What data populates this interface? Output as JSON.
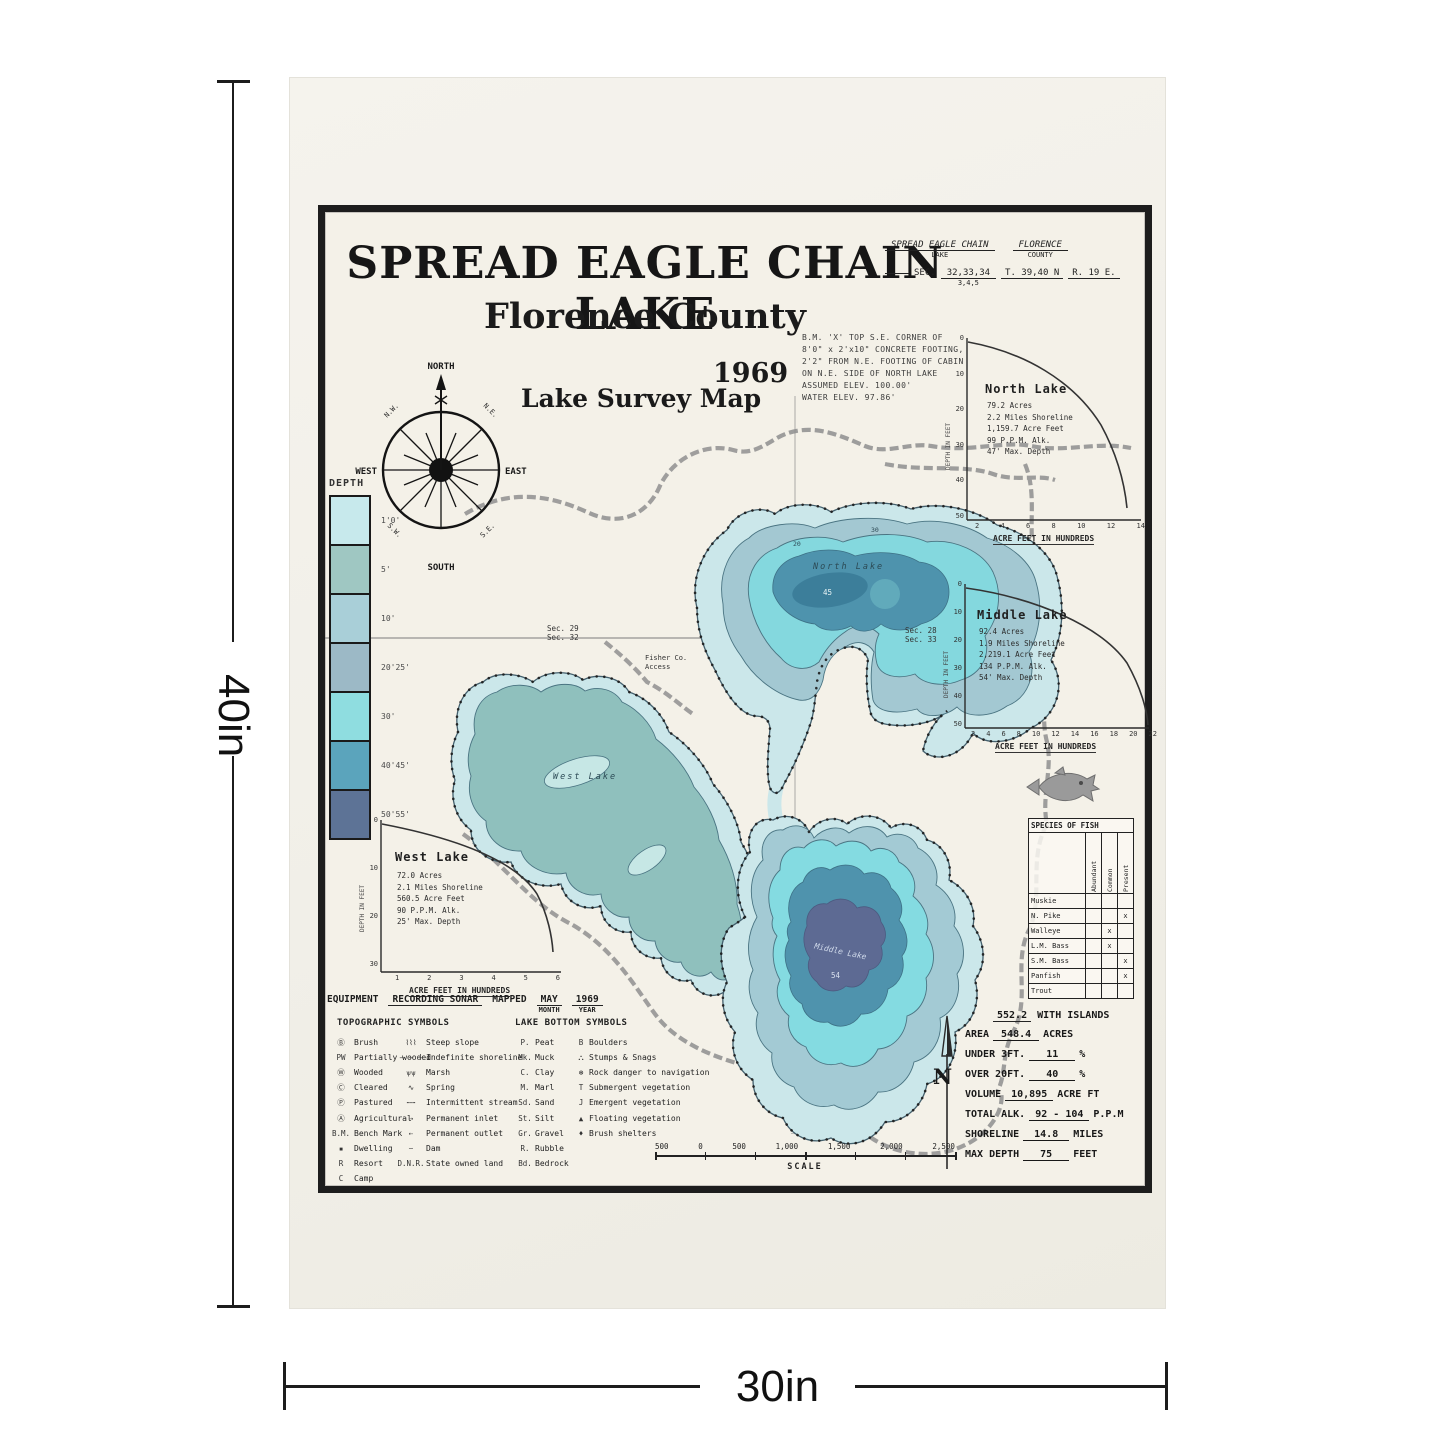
{
  "dimensions": {
    "height_label": "40in",
    "width_label": "30in"
  },
  "poster": {
    "title": "SPREAD EAGLE CHAIN LAKE",
    "subtitle": "Florence County",
    "year": "1969",
    "map_type": "Lake Survey Map",
    "form": {
      "lake_value": "SPREAD EAGLE CHAIN",
      "lake_label": "LAKE",
      "county_value": "FLORENCE",
      "county_label": "COUNTY",
      "sec_label": "SEC.",
      "sec_value": "32,33,34",
      "sec_value2": "3,4,5",
      "township": "T. 39,40 N",
      "range": "R. 19 E."
    },
    "bench_mark_note": [
      "B.M. 'X' TOP S.E. CORNER OF",
      "8'0\" x 2'x10\" CONCRETE FOOTING,",
      "2'2\" FROM N.E. FOOTING OF CABIN",
      "ON N.E. SIDE OF NORTH LAKE",
      "ASSUMED ELEV. 100.00'",
      "WATER ELEV. 97.86'"
    ],
    "compass": {
      "north": "NORTH",
      "south": "SOUTH",
      "west": "WEST",
      "east": "EAST",
      "nw": "N.W.",
      "ne": "N.E.",
      "sw": "S.W.",
      "se": "S.E."
    },
    "depth_legend": {
      "title": "DEPTH",
      "entries": [
        {
          "label": "1'0'",
          "color": "#c7e9ec"
        },
        {
          "label": "5'",
          "color": "#9fc7c2"
        },
        {
          "label": "10'",
          "color": "#a9cfd8"
        },
        {
          "label": "20'25'",
          "color": "#9cb9c6"
        },
        {
          "label": "30'",
          "color": "#8fdde0"
        },
        {
          "label": "40'45'",
          "color": "#5ba4bc"
        },
        {
          "label": "50'55'",
          "color": "#5d7396"
        }
      ]
    },
    "graphs": {
      "north": {
        "title": "North Lake",
        "stats": [
          "79.2 Acres",
          "2.2 Miles Shoreline",
          "1,159.7 Acre Feet",
          "99 P.P.M. Alk.",
          "47' Max. Depth"
        ],
        "xlabel": "ACRE FEET IN HUNDREDS",
        "ylabel": "DEPTH IN FEET",
        "xticks": [
          "2",
          "4",
          "6",
          "8",
          "10",
          "12",
          "14"
        ],
        "yticks": [
          "0",
          "10",
          "20",
          "30",
          "40",
          "50"
        ],
        "curve_points": [
          [
            0,
            0
          ],
          [
            4,
            9
          ],
          [
            8,
            21
          ],
          [
            11,
            32
          ],
          [
            13,
            41
          ],
          [
            14,
            47
          ]
        ]
      },
      "middle": {
        "title": "Middle Lake",
        "stats": [
          "92.4 Acres",
          "1.9 Miles Shoreline",
          "2,219.1 Acre Feet",
          "134 P.P.M. Alk.",
          "54' Max. Depth"
        ],
        "xlabel": "ACRE FEET IN HUNDREDS",
        "ylabel": "DEPTH IN FEET",
        "xticks": [
          "2",
          "4",
          "6",
          "8",
          "10",
          "12",
          "14",
          "16",
          "18",
          "20",
          "22"
        ],
        "yticks": [
          "0",
          "10",
          "20",
          "30",
          "40",
          "50"
        ],
        "curve_points": [
          [
            0,
            0
          ],
          [
            6,
            8
          ],
          [
            12,
            20
          ],
          [
            17,
            31
          ],
          [
            20,
            41
          ],
          [
            22,
            54
          ]
        ]
      },
      "west": {
        "title": "West Lake",
        "stats": [
          "72.0 Acres",
          "2.1 Miles Shoreline",
          "560.5 Acre Feet",
          "90 P.P.M. Alk.",
          "25' Max. Depth"
        ],
        "xlabel": "ACRE FEET IN HUNDREDS",
        "ylabel": "DEPTH IN FEET",
        "xticks": [
          "1",
          "2",
          "3",
          "4",
          "5",
          "6"
        ],
        "yticks": [
          "0",
          "10",
          "20",
          "30"
        ],
        "curve_points": [
          [
            0,
            0
          ],
          [
            2,
            5
          ],
          [
            4,
            12
          ],
          [
            5,
            19
          ],
          [
            6,
            25
          ]
        ]
      }
    },
    "species_table": {
      "title": "SPECIES OF FISH",
      "columns": [
        "Abundant",
        "Common",
        "Present"
      ],
      "rows": [
        {
          "name": "Muskie",
          "marks": [
            "",
            "",
            ""
          ]
        },
        {
          "name": "N. Pike",
          "marks": [
            "",
            "",
            "x"
          ]
        },
        {
          "name": "Walleye",
          "marks": [
            "",
            "x",
            ""
          ]
        },
        {
          "name": "L.M. Bass",
          "marks": [
            "",
            "x",
            ""
          ]
        },
        {
          "name": "S.M. Bass",
          "marks": [
            "",
            "",
            "x"
          ]
        },
        {
          "name": "Panfish",
          "marks": [
            "",
            "",
            "x"
          ]
        },
        {
          "name": "Trout",
          "marks": [
            "",
            "",
            ""
          ]
        }
      ]
    },
    "stats_block": {
      "north_label": "N",
      "islands_value": "552.2",
      "islands_label": "WITH ISLANDS",
      "rows": [
        {
          "label": "AREA",
          "value": "548.4",
          "unit": "ACRES"
        },
        {
          "label": "UNDER 3FT.",
          "value": "11",
          "unit": "%"
        },
        {
          "label": "OVER 20FT.",
          "value": "40",
          "unit": "%"
        },
        {
          "label": "VOLUME",
          "value": "10,895",
          "unit": "ACRE FT"
        },
        {
          "label": "TOTAL ALK.",
          "value": "92 - 104",
          "unit": "P.P.M"
        },
        {
          "label": "SHORELINE",
          "value": "14.8",
          "unit": "MILES"
        },
        {
          "label": "MAX DEPTH",
          "value": "75",
          "unit": "FEET"
        }
      ]
    },
    "equipment": {
      "label": "EQUIPMENT",
      "value": "RECORDING SONAR",
      "mapped_label": "MAPPED",
      "month_value": "MAY",
      "year_value": "1969",
      "month_label": "MONTH",
      "year_label": "YEAR"
    },
    "topo_symbols": {
      "title": "TOPOGRAPHIC SYMBOLS",
      "col1": [
        {
          "sym": "Ⓑ",
          "label": "Brush"
        },
        {
          "sym": "PW",
          "label": "Partially wooded"
        },
        {
          "sym": "Ⓦ",
          "label": "Wooded"
        },
        {
          "sym": "Ⓒ",
          "label": "Cleared"
        },
        {
          "sym": "Ⓟ",
          "label": "Pastured"
        },
        {
          "sym": "Ⓐ",
          "label": "Agricultural"
        },
        {
          "sym": "B.M.",
          "label": "Bench Mark"
        },
        {
          "sym": "▪",
          "label": "Dwelling"
        },
        {
          "sym": "R",
          "label": "Resort"
        },
        {
          "sym": "C",
          "label": "Camp"
        }
      ],
      "col2": [
        {
          "sym": "⌇⌇⌇",
          "label": "Steep slope"
        },
        {
          "sym": "– – –",
          "label": "Indefinite shoreline"
        },
        {
          "sym": "ѱѱ",
          "label": "Marsh"
        },
        {
          "sym": "∿",
          "label": "Spring"
        },
        {
          "sym": "⋯⋯",
          "label": "Intermittent stream"
        },
        {
          "sym": "⇢",
          "label": "Permanent inlet"
        },
        {
          "sym": "⇠",
          "label": "Permanent outlet"
        },
        {
          "sym": "⌣",
          "label": "Dam"
        },
        {
          "sym": "D.N.R.",
          "label": "State owned land"
        }
      ]
    },
    "bottom_symbols": {
      "title": "LAKE BOTTOM SYMBOLS",
      "col1": [
        {
          "sym": "P.",
          "label": "Peat"
        },
        {
          "sym": "Mk.",
          "label": "Muck"
        },
        {
          "sym": "C.",
          "label": "Clay"
        },
        {
          "sym": "M.",
          "label": "Marl"
        },
        {
          "sym": "Sd.",
          "label": "Sand"
        },
        {
          "sym": "St.",
          "label": "Silt"
        },
        {
          "sym": "Gr.",
          "label": "Gravel"
        },
        {
          "sym": "R.",
          "label": "Rubble"
        },
        {
          "sym": "Bd.",
          "label": "Bedrock"
        }
      ],
      "col2": [
        {
          "sym": "B",
          "label": "Boulders"
        },
        {
          "sym": "⛬",
          "label": "Stumps & Snags"
        },
        {
          "sym": "⊛",
          "label": "Rock danger to navigation"
        },
        {
          "sym": "T",
          "label": "Submergent vegetation"
        },
        {
          "sym": "J",
          "label": "Emergent vegetation"
        },
        {
          "sym": "▲",
          "label": "Floating vegetation"
        },
        {
          "sym": "♦",
          "label": "Brush shelters"
        }
      ]
    },
    "scale": {
      "labels": [
        "500",
        "0",
        "500",
        "1,000",
        "1,500",
        "2,000",
        "2,500"
      ],
      "word": "SCALE"
    },
    "map_labels": {
      "north_lake": "North Lake",
      "west_lake": "West Lake",
      "middle_lake": "Middle Lake",
      "sec_left_top": "Sec. 29",
      "sec_left_bottom": "Sec. 32",
      "sec_right_top": "Sec. 28",
      "sec_right_bottom": "Sec. 33",
      "access_line1": "Fisher Co.",
      "access_line2": "Access",
      "depth_mark_north_ring1": "20",
      "depth_mark_north_ring2": "30",
      "depth_mark_north_center": "45",
      "depth_mark_middle_center": "54"
    },
    "colors": {
      "shallow": "#cbe7ea",
      "mid": "#a3c8d2",
      "bright": "#84d8de",
      "deep": "#4e93ad",
      "deepest": "#5d6a93",
      "west_inner": "#8fc0bd",
      "road": "#8f8f8f",
      "frame": "#1d1d1d"
    }
  }
}
